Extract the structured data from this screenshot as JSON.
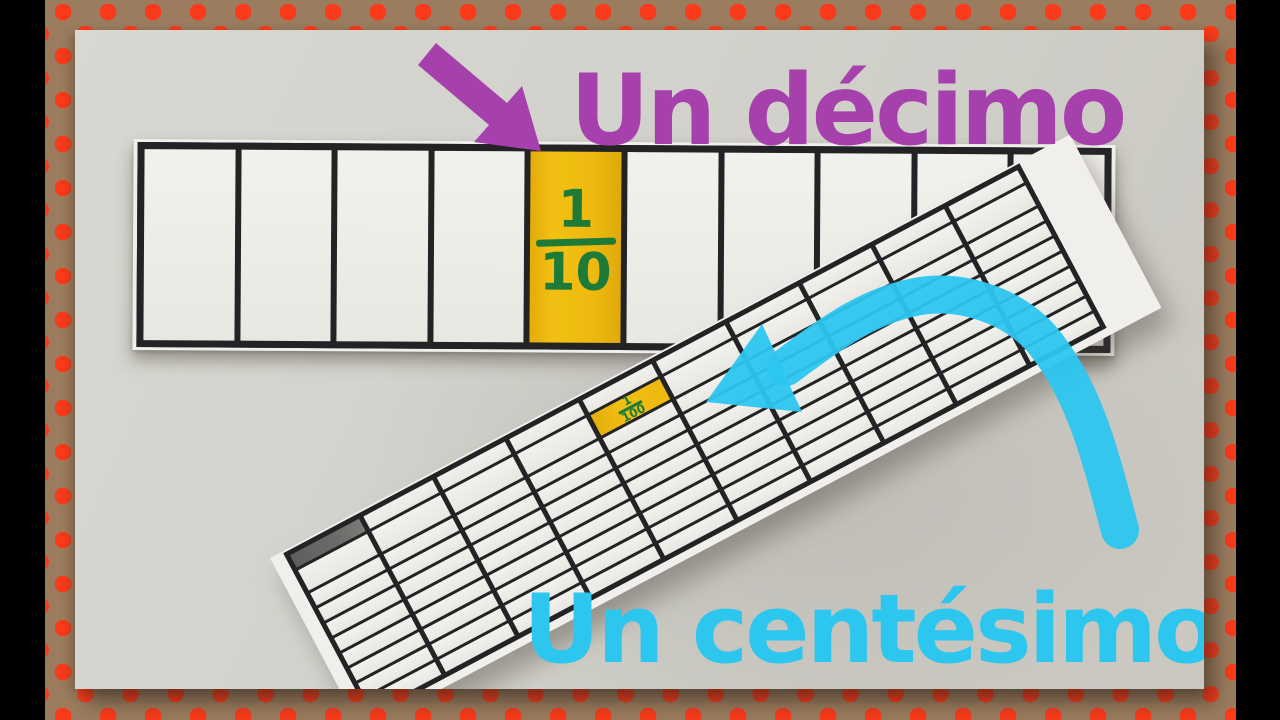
{
  "colors": {
    "edge-bar": "#000000",
    "frame-brown": "#9b7c5e",
    "dot-red": "#f93b1b",
    "table-light": "#d8d7d1",
    "table-dark": "#c9c7c0",
    "paper": "#f1efeb",
    "line": "#232326",
    "cell-white": "#f3f1ed",
    "yellow": "#eeb90f",
    "green": "#1d7a37",
    "gray-cell": "#6b6b69",
    "purple": "#a640ac",
    "cyan": "#2cc6ef"
  },
  "labels": {
    "tenth": "Un décimo",
    "hundredth": "Un centésimo"
  },
  "tenths_strip": {
    "cell_count": 10,
    "highlighted_index": 4,
    "fraction": {
      "numerator": "1",
      "denominator": "10"
    }
  },
  "hundredths_strip": {
    "columns": 10,
    "rows": 10,
    "rotation_deg": -27.9,
    "highlighted_cell": {
      "row": 1,
      "col": 4
    },
    "shaded_cell": {
      "row": 0,
      "col": 0
    },
    "fraction": {
      "numerator": "1",
      "denominator": "100"
    }
  }
}
